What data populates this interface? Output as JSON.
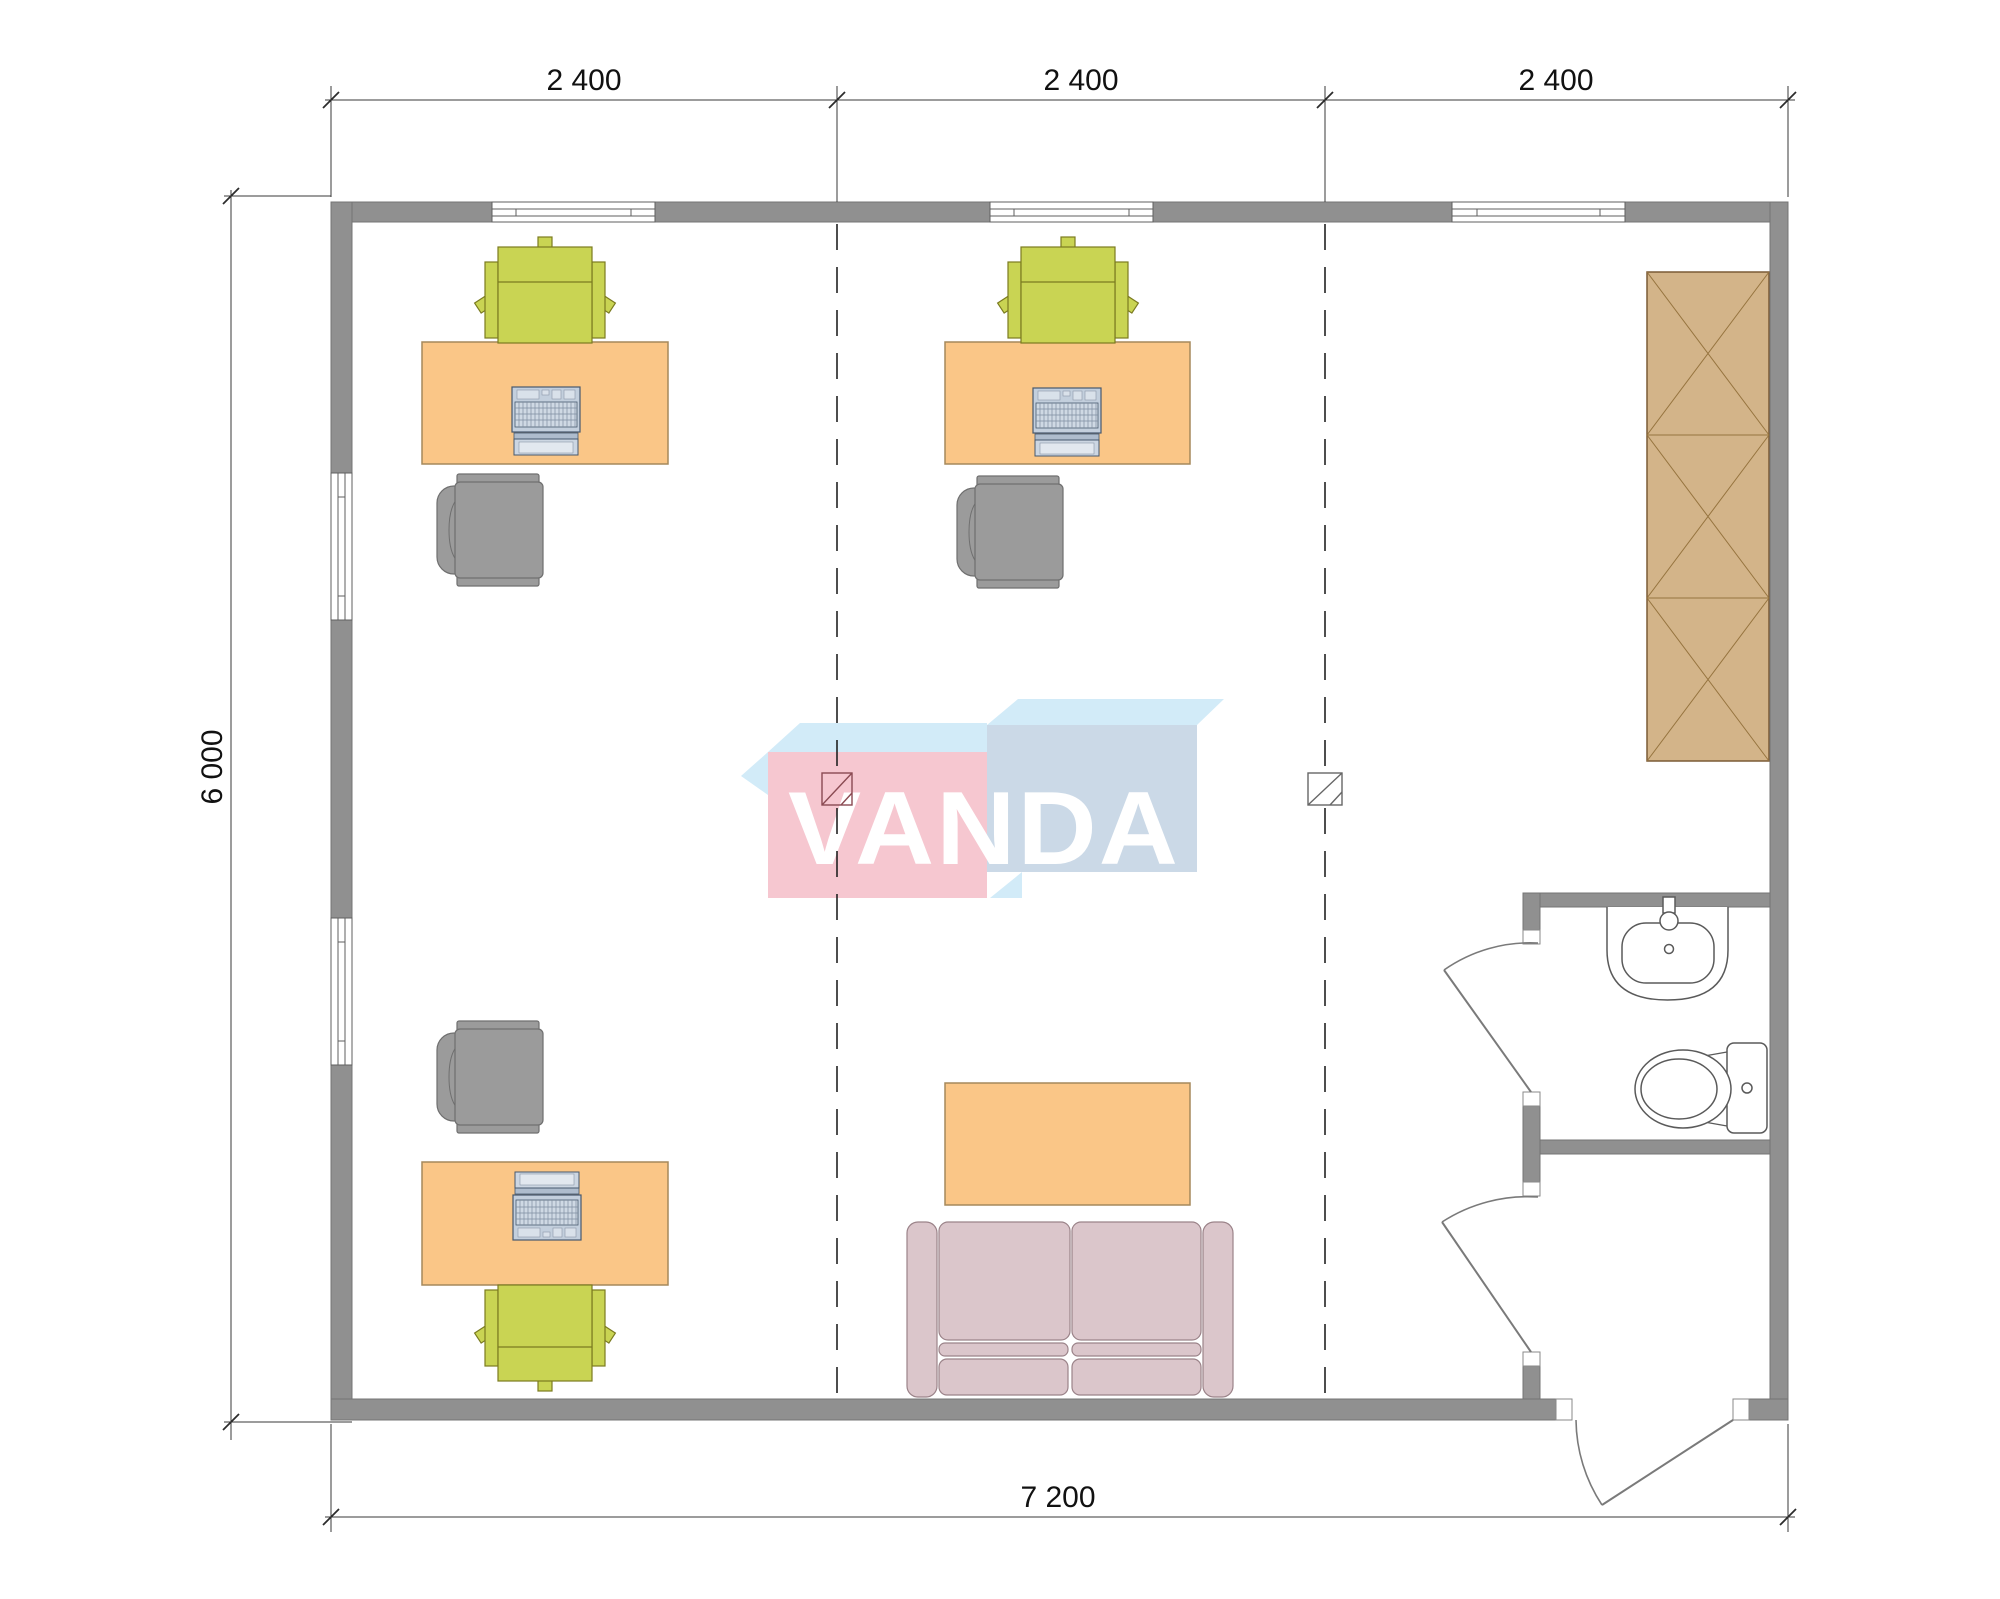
{
  "title": "VANDA modular office floor plan",
  "dims": {
    "top": [
      "2 400",
      "2 400",
      "2 400"
    ],
    "left": "6 000",
    "bottom": "7 200"
  },
  "logo": {
    "text": "VANDA"
  },
  "colors": {
    "wall": "#909090",
    "axis": "#222222",
    "desk": "#fac687",
    "desk_border": "#a5895b",
    "chair_green": "#c9d453",
    "chair_green_border": "#7b7b20",
    "chair_gray": "#9b9b9b",
    "chair_gray_border": "#6f6f6f",
    "laptop_body": "#c3cfdd",
    "wardrobe": "#d3b489",
    "wardrobe_border": "#7b5b36",
    "wardrobe_line": "#96743f",
    "sofa": "#dbc6cb",
    "sofa_border": "#9b8389",
    "fixture": "#5a5a5a",
    "logo_pink": "#f6c7d0",
    "logo_blue": "#cbd9e7",
    "logo_blue_light": "#d2ebf8",
    "marker1": "#8a4a52",
    "marker2": "#666666"
  }
}
